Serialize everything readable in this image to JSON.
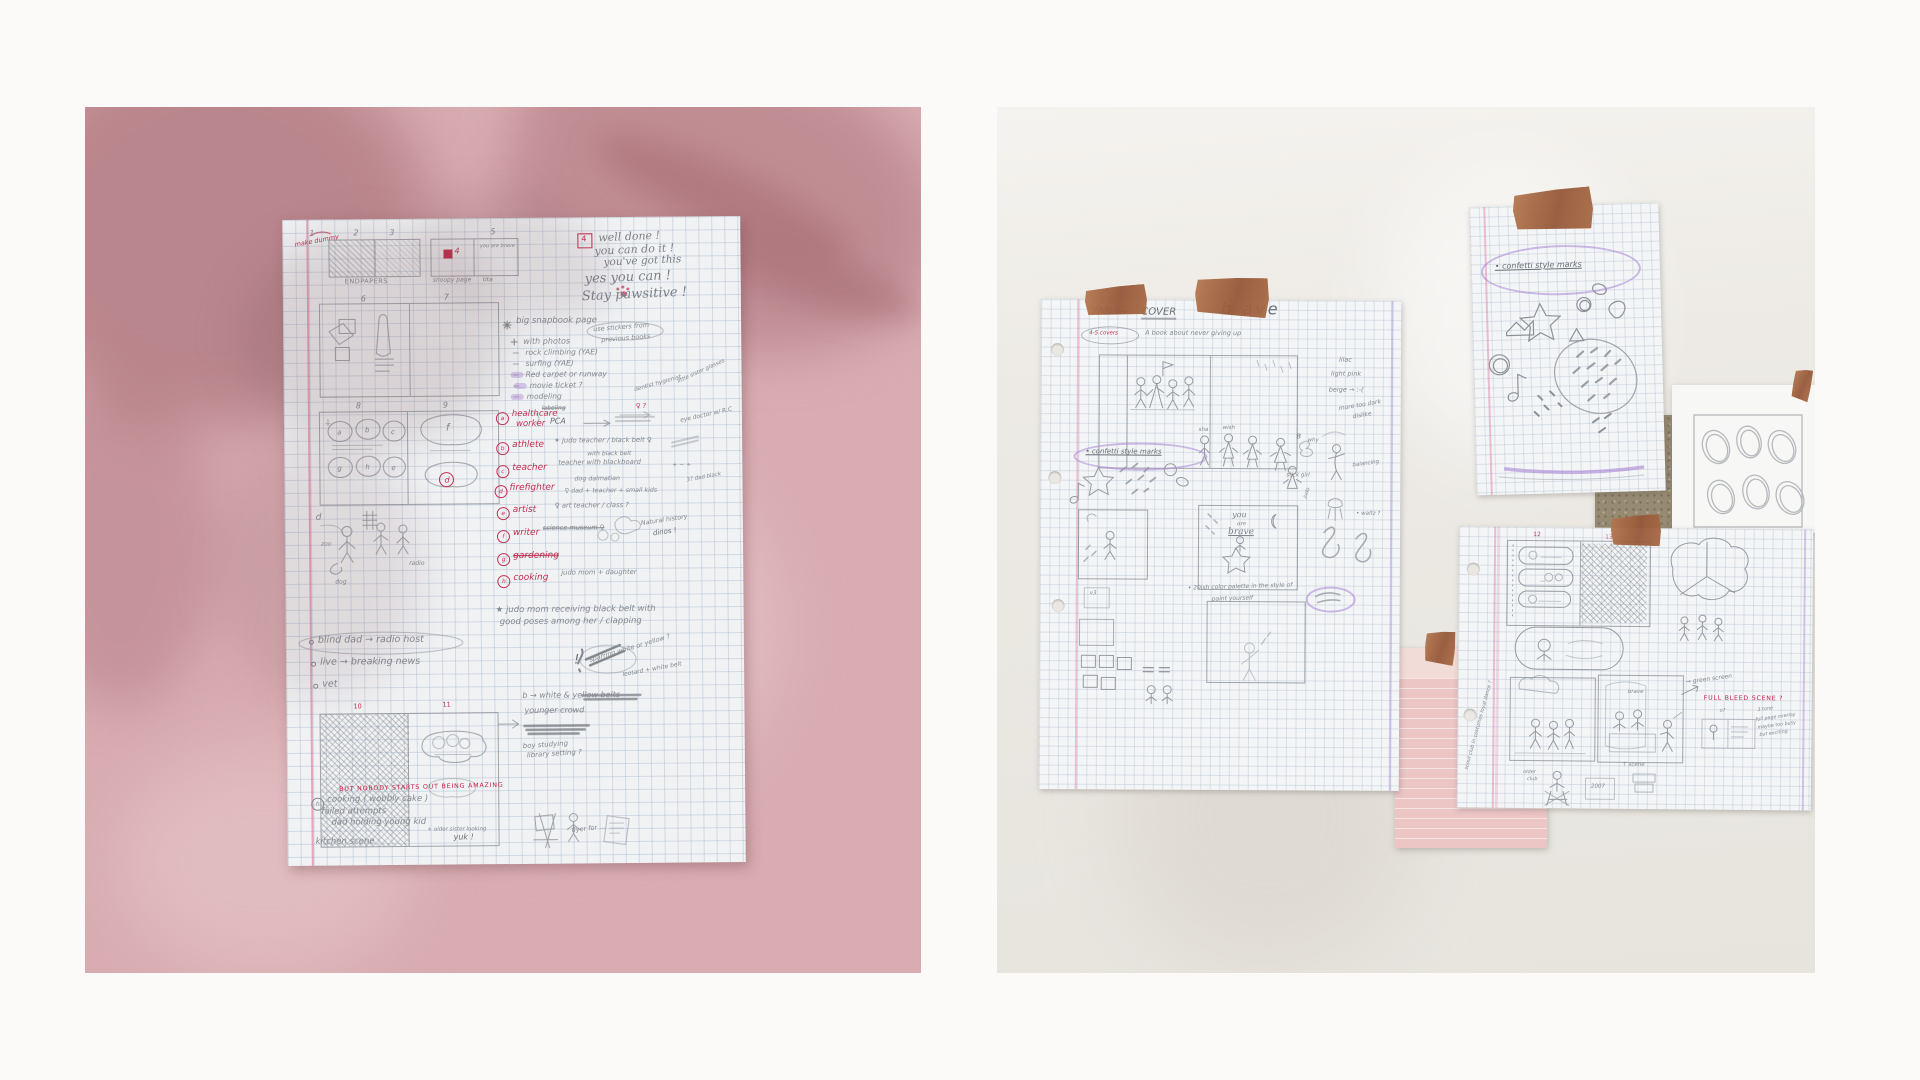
{
  "meta": {
    "description": "Two photo panels pinned side by side: left — a storyboard/sketch planning page on a pink wall with leaf shadows; right — several grid-paper sketch sheets taped to a white wall",
    "canvas": {
      "width": 1920,
      "height": 1080
    }
  },
  "palette": {
    "outer_background": "#fbfaf8",
    "wall_pink": "#d8acb1",
    "wall_white": "#edeae5",
    "paper": "#f0f2f4",
    "pencil_grey": "#84888e",
    "red_pen": "#c23052",
    "purple_marker": "#a982d6",
    "tape_copper": "#a3623f",
    "cork_brown": "#968a72",
    "pink_paper": "#ecc5c5"
  },
  "left_page": {
    "corner_note": "make dummy",
    "frame_numbers": [
      "1",
      "2",
      "3",
      "4",
      "5",
      "6",
      "7",
      "8",
      "9",
      "10",
      "11"
    ],
    "caption_endpapers": "ENDPAPERS",
    "caption_snoopy": "snoopy page",
    "caption_tita": "tita",
    "mini_cover_text": "you are brave",
    "boxed_num": "4",
    "pep_talk": [
      "well done !",
      "you can do it !",
      "you've got this",
      "yes you can !",
      "Stay pawsitive !"
    ],
    "ideas_title": "big snapbook page",
    "ideas": [
      "with photos",
      "rock climbing (YAE)",
      "surfing (YAE)",
      "Red carpet or runway",
      "movie ticket ?",
      "modeling"
    ],
    "stickers_note_1": "use stickers from",
    "stickers_note_2": "previous books",
    "cell_letters": [
      "a",
      "b",
      "c",
      "g",
      "h",
      "e",
      "f",
      "d"
    ],
    "letter_d": "d",
    "fem_mark": "♀ ?",
    "excl": "!",
    "professions": [
      {
        "letter": "a",
        "label": "healthcare",
        "label2": "worker",
        "note": "PCA",
        "extra": "labeling"
      },
      {
        "letter": "b",
        "label": "athlete",
        "note": "✶ judo teacher / black belt ♀",
        "note2": "with black belt"
      },
      {
        "letter": "c",
        "label": "teacher",
        "note": "teacher with blackboard",
        "note2": "+ − ÷"
      },
      {
        "letter": "d",
        "label": "firefighter",
        "note": "dog dalmatian",
        "note2": "♀ dad + teacher + small kids"
      },
      {
        "letter": "e",
        "label": "artist",
        "note": "♀ art teacher / class ?"
      },
      {
        "letter": "f",
        "label": "writer",
        "note": "science museum ♀"
      },
      {
        "letter": "g",
        "label": "gardening"
      },
      {
        "letter": "h",
        "label": "cooking",
        "note": "judo mom + daughter"
      }
    ],
    "side_notes": [
      "dentist hygienist",
      "little sister glasses",
      "eye doctor w/ R.C",
      "3? dad black",
      "Natural history",
      "dinos !"
    ],
    "bullets": [
      "blind dad → radio host",
      "live → breaking news",
      "vet"
    ],
    "sketch_labels": [
      "zoo",
      "dog",
      "radio"
    ],
    "judo_note_1": "★ judo mom receiving black belt with",
    "judo_note_2": "good poses among her / clapping",
    "belt_note_1": "sparring white or yellow ?",
    "belt_note_2": "leotard + white belt",
    "belt_note_3": "b → white & yellow belts",
    "belt_note_4": "younger crowd",
    "library_note_1": "boy studying",
    "library_note_2": "library setting ?",
    "slogan": "BUT NOBODY STARTS OUT BEING AMAZING",
    "cooking_letter": "h",
    "cooking_lines": [
      "cooking ( wobbly cake )",
      "failed attempts",
      "dad holding young kid",
      "+ older sister looking",
      "yuk !",
      "kitchen scene"
    ],
    "flyer_note": "flyer for ..."
  },
  "right_panel": {
    "cover_sheet": {
      "title": "YAB",
      "arrow": "→",
      "title2": "COVER",
      "badge": "4-5 covers",
      "subtitle": "A book about never giving up",
      "brave_heading": "b ave",
      "color_notes": [
        "lilac",
        "light pink",
        "beige → :-(",
        "more too dark",
        "dislike"
      ],
      "confetti_note": "• confetti style marks",
      "labels": [
        "sha",
        "wish",
        "stick girl",
        "B",
        "why",
        "balancing",
        "judo",
        "• waltz ?"
      ],
      "you_are_brave": [
        "you",
        "are",
        "brave"
      ],
      "v3": "v3",
      "palette_note_1": "• 20ish color palette in the style of",
      "palette_note_2": "paint yourself"
    },
    "confetti_sheet": {
      "note": "• confetti style marks"
    },
    "storyboard_sheet": {
      "numbers": [
        "12",
        "13"
      ],
      "brave_label": "brave",
      "green_screen": "→ green screen",
      "full_bleed": "FULL BLEED SCENE ?",
      "panel_mark": "o?",
      "scene_label": "↑ scene",
      "older_club_1": "older",
      "older_club_2": "club",
      "year": "2007",
      "margin_note": "scout club in costumes loyal dance ?",
      "tone_note_lines": [
        "3 tone",
        "full page overlay",
        "maybe too busy",
        "but exciting"
      ]
    }
  }
}
